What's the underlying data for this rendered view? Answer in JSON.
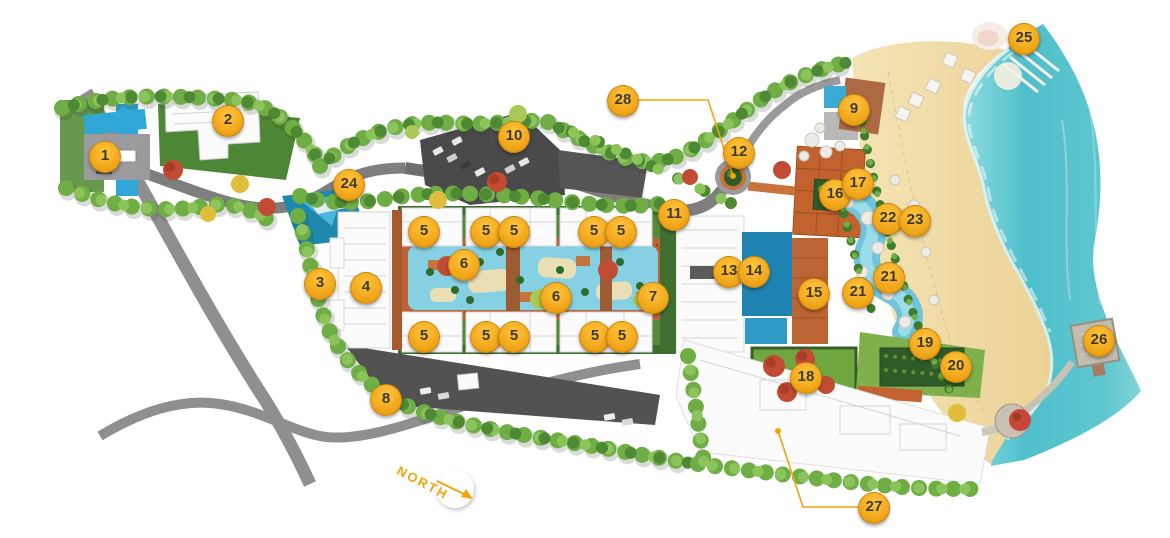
{
  "map": {
    "compass": {
      "label": "NORTH"
    },
    "colors": {
      "marker_fill": "#F2A71B",
      "marker_highlight": "#FFC53D",
      "marker_text": "#3F3A30",
      "leader_line": "#F0A50A",
      "ocean": "#4FBFCB",
      "sand": "#F0DAA3",
      "road": "#8A8A8A",
      "parking": "#4E4E4E",
      "foliage": "#6FAE44",
      "lagoon_pool": "#86D0E4",
      "hotel_pool": "#1F83B2",
      "deck_terracotta": "#BD6434",
      "building": "#FBFBFB",
      "lawn": "#6FA63F",
      "garden_dark": "#2F5B28"
    },
    "markers": [
      {
        "label": "1",
        "x": 104,
        "y": 156
      },
      {
        "label": "2",
        "x": 227,
        "y": 120
      },
      {
        "label": "3",
        "x": 319,
        "y": 283
      },
      {
        "label": "4",
        "x": 365,
        "y": 287
      },
      {
        "label": "5",
        "x": 423,
        "y": 231
      },
      {
        "label": "5",
        "x": 485,
        "y": 231
      },
      {
        "label": "5",
        "x": 513,
        "y": 231
      },
      {
        "label": "5",
        "x": 593,
        "y": 231
      },
      {
        "label": "5",
        "x": 620,
        "y": 231
      },
      {
        "label": "5",
        "x": 423,
        "y": 336
      },
      {
        "label": "5",
        "x": 485,
        "y": 336
      },
      {
        "label": "5",
        "x": 513,
        "y": 336
      },
      {
        "label": "5",
        "x": 594,
        "y": 336
      },
      {
        "label": "5",
        "x": 621,
        "y": 336
      },
      {
        "label": "6",
        "x": 463,
        "y": 264
      },
      {
        "label": "6",
        "x": 555,
        "y": 297
      },
      {
        "label": "7",
        "x": 652,
        "y": 297
      },
      {
        "label": "8",
        "x": 385,
        "y": 399
      },
      {
        "label": "9",
        "x": 853,
        "y": 109
      },
      {
        "label": "10",
        "x": 513,
        "y": 136
      },
      {
        "label": "11",
        "x": 673,
        "y": 214
      },
      {
        "label": "12",
        "x": 738,
        "y": 152
      },
      {
        "label": "13",
        "x": 728,
        "y": 271
      },
      {
        "label": "14",
        "x": 753,
        "y": 271
      },
      {
        "label": "15",
        "x": 813,
        "y": 293
      },
      {
        "label": "16",
        "x": 834,
        "y": 194
      },
      {
        "label": "17",
        "x": 857,
        "y": 183
      },
      {
        "label": "18",
        "x": 805,
        "y": 377
      },
      {
        "label": "19",
        "x": 924,
        "y": 343
      },
      {
        "label": "20",
        "x": 955,
        "y": 366
      },
      {
        "label": "21",
        "x": 857,
        "y": 292
      },
      {
        "label": "21",
        "x": 888,
        "y": 277
      },
      {
        "label": "22",
        "x": 887,
        "y": 218
      },
      {
        "label": "23",
        "x": 914,
        "y": 220
      },
      {
        "label": "24",
        "x": 348,
        "y": 184
      },
      {
        "label": "25",
        "x": 1023,
        "y": 38
      },
      {
        "label": "26",
        "x": 1098,
        "y": 340
      },
      {
        "label": "27",
        "x": 873,
        "y": 507
      },
      {
        "label": "28",
        "x": 622,
        "y": 100
      }
    ],
    "leaders": [
      {
        "for": "28",
        "points": "637,100 708,100 733,176",
        "dot": {
          "x": 733,
          "y": 176
        }
      },
      {
        "for": "27",
        "points": "858,507 803,507 778,431",
        "dot": {
          "x": 778,
          "y": 431
        }
      }
    ]
  }
}
